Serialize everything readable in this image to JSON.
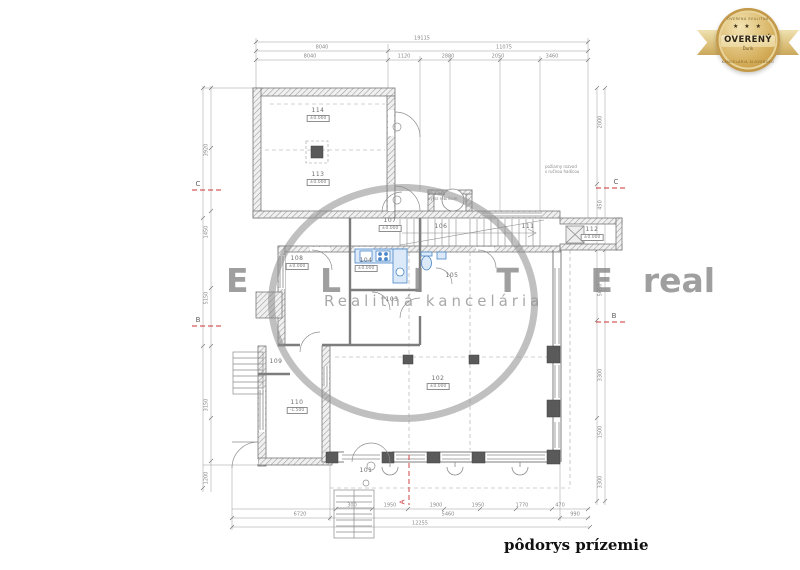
{
  "caption": "pôdorys prízemie",
  "badge": {
    "stars": "★ ★ ★",
    "title": "OVERENÝ",
    "subtitle": "Ďurik",
    "arc_top": "OVERENÁ REALITNÁ",
    "arc_bottom": "KANCELÁRIA SLOVENSKO",
    "gold": "#cfa852"
  },
  "watermark": {
    "brand_first": "E L I T E",
    "brand_second": "real",
    "tagline": "Realitná kancelária",
    "color": "#8a8a8a"
  },
  "grid": {
    "left_c": "C",
    "left_b": "B",
    "right_c": "C",
    "right_b": "B"
  },
  "section": {
    "label": "A"
  },
  "rooms": [
    {
      "label": "114",
      "elev": "±0.000"
    },
    {
      "label": "113",
      "elev": "±0.000"
    },
    {
      "label": "108",
      "elev": "±0.000"
    },
    {
      "label": "107",
      "elev": "±0.000"
    },
    {
      "label": "106",
      "elev": ""
    },
    {
      "label": "111",
      "elev": ""
    },
    {
      "label": "112",
      "elev": "±0.000"
    },
    {
      "label": "104",
      "elev": "±0.000"
    },
    {
      "label": "103",
      "elev": ""
    },
    {
      "label": "105",
      "elev": ""
    },
    {
      "label": "109",
      "elev": ""
    },
    {
      "label": "110",
      "elev": "-1.500"
    },
    {
      "label": "102",
      "elev": "±0.000"
    },
    {
      "label": "101",
      "elev": ""
    }
  ],
  "notes": {
    "hatch_l1": "2×2.075",
    "hatch_l2": "výlez rebríkom",
    "hydrant_l1": "požiarny rozvod",
    "hydrant_l2": "s ručnou hadicou"
  },
  "dims": {
    "top": [
      "19115",
      "8040",
      "11075",
      "8040",
      "1120",
      "2880",
      "2050",
      "3460"
    ],
    "left": [
      "3920",
      "1450",
      "5150",
      "3150",
      "1200"
    ],
    "right": [
      "2000",
      "450",
      "5650",
      "3300",
      "1500",
      "3300"
    ],
    "bottom": [
      "300",
      "1950",
      "1900",
      "1950",
      "1770",
      "470",
      "6720",
      "5460",
      "990",
      "12255"
    ]
  },
  "colors": {
    "plan_line": "#8a8a8a",
    "wall_dark": "#5a5a5a",
    "fixture_blue": "#4a86c8",
    "section_red": "#cc3333"
  }
}
